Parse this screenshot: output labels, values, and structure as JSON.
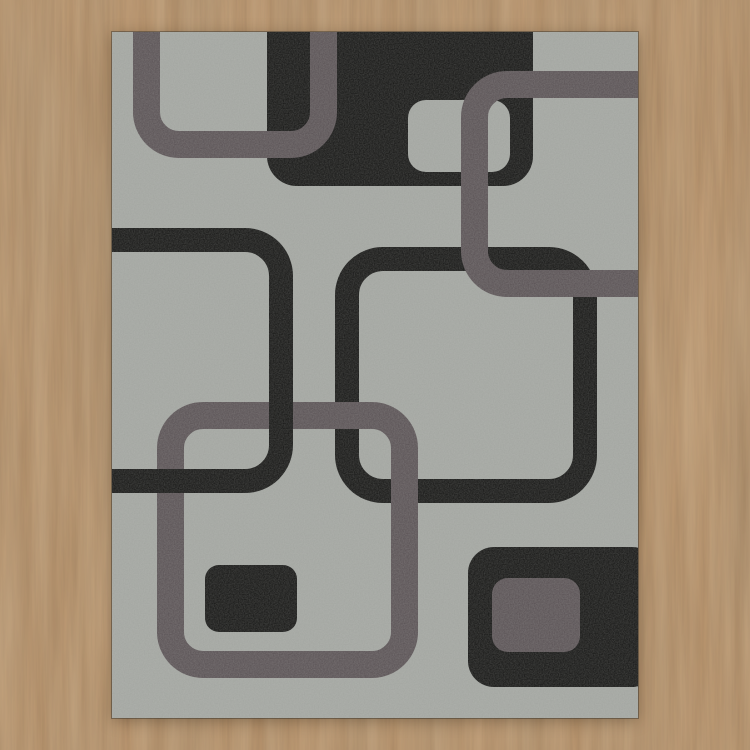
{
  "scene": {
    "title": "Gray retro area rug with rounded-square pattern on a wooden floor",
    "floor": {
      "material": "wood",
      "grain_direction": "vertical",
      "base_color": "#bb9167",
      "dark_streak_color": "#6e5134",
      "light_streak_color": "#c9a173"
    },
    "rug": {
      "left": 112,
      "top": 32,
      "width": 526,
      "height": 686,
      "palette": {
        "black": "#131312",
        "gray": "#585053",
        "rug": "#a2a5a0"
      },
      "shapes": [
        {
          "name": "black-square-top",
          "kind": "fill",
          "x": 155,
          "y": -40,
          "w": 266,
          "h": 194,
          "rx": 30,
          "color": "black"
        },
        {
          "name": "gray-notch-top",
          "kind": "fill",
          "x": 296,
          "y": 68,
          "w": 102,
          "h": 72,
          "rx": 18,
          "color": "rug"
        },
        {
          "name": "black-outline-square-right",
          "kind": "outline",
          "x": 223,
          "y": 215,
          "w": 262,
          "h": 256,
          "rx": 48,
          "sw": 24,
          "color": "black"
        },
        {
          "name": "gray-outline-square-topleft",
          "kind": "outline",
          "x": 21,
          "y": -60,
          "w": 204,
          "h": 186,
          "rx": 46,
          "sw": 27,
          "color": "gray"
        },
        {
          "name": "gray-outline-square-topright",
          "kind": "outline",
          "x": 349,
          "y": 39,
          "w": 255,
          "h": 226,
          "rx": 46,
          "sw": 27,
          "color": "gray"
        },
        {
          "name": "gray-outline-square-center",
          "kind": "outline",
          "x": 45,
          "y": 370,
          "w": 261,
          "h": 276,
          "rx": 46,
          "sw": 27,
          "color": "gray"
        },
        {
          "name": "black-outline-square-left",
          "kind": "outline",
          "x": -70,
          "y": 196,
          "w": 251,
          "h": 265,
          "rx": 48,
          "sw": 24,
          "color": "black"
        },
        {
          "name": "black-rect-small",
          "kind": "fill",
          "x": 93,
          "y": 533,
          "w": 92,
          "h": 67,
          "rx": 14,
          "color": "black"
        },
        {
          "name": "black-square-bottomright",
          "kind": "fill",
          "x": 356,
          "y": 515,
          "w": 190,
          "h": 140,
          "rx": 26,
          "color": "black"
        },
        {
          "name": "gray-rect-inner",
          "kind": "fill",
          "x": 380,
          "y": 546,
          "w": 88,
          "h": 74,
          "rx": 16,
          "color": "gray"
        }
      ]
    }
  }
}
